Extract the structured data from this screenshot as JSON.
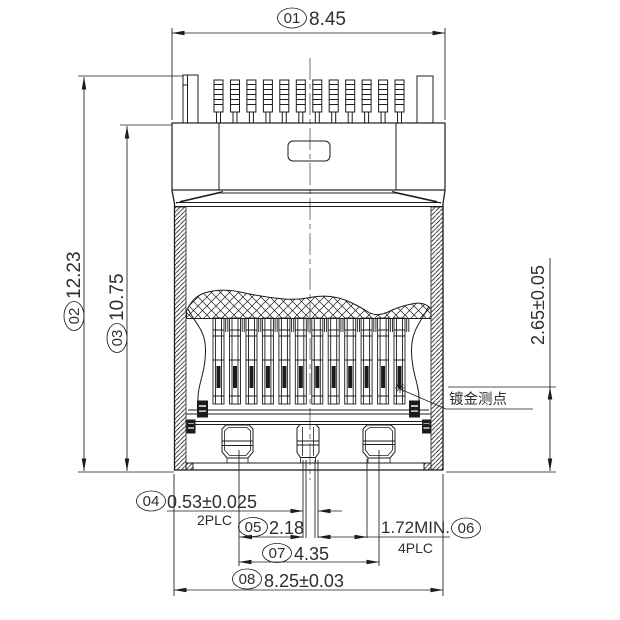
{
  "drawing": {
    "type": "engineering-drawing",
    "view": "connector-front-section-view",
    "units": "mm",
    "pin_count": 12,
    "colors": {
      "line": "#1c1c1c",
      "text": "#2e2e2e",
      "background": "#ffffff"
    },
    "balloons": {
      "d01": {
        "id": "01",
        "value": "8.45"
      },
      "d02": {
        "id": "02",
        "value": "12.23"
      },
      "d03": {
        "id": "03",
        "value": "10.75"
      },
      "d04": {
        "id": "04",
        "value": "0.53±0.025",
        "places": "2PLC"
      },
      "d05": {
        "id": "05",
        "value": "2.18"
      },
      "d06": {
        "id": "06",
        "value": "1.72MIN.",
        "places": "4PLC"
      },
      "d07": {
        "id": "07",
        "value": "4.35"
      },
      "d08": {
        "id": "08",
        "value": "8.25±0.03"
      },
      "right": {
        "value": "2.65±0.05"
      }
    },
    "annotations": {
      "gold_test_point": "镀金测点"
    }
  }
}
